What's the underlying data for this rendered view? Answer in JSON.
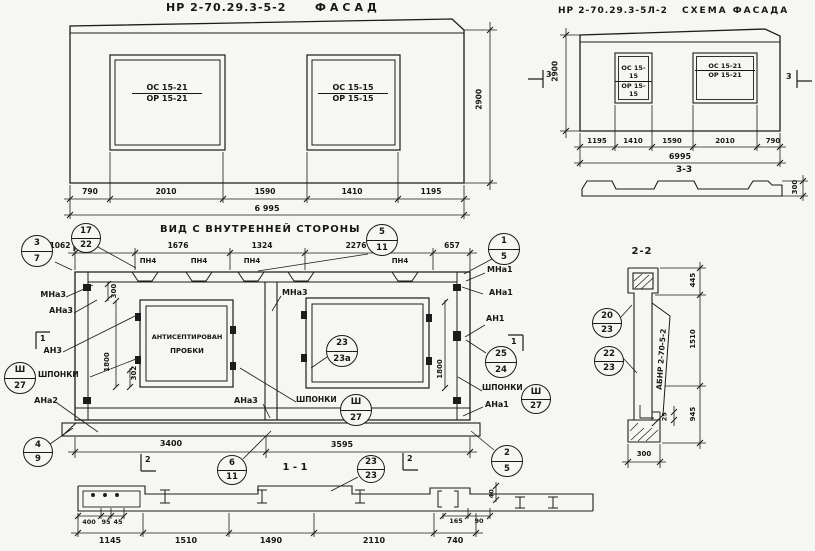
{
  "fl": {
    "code": "НР 2-70.29.3-5-2",
    "name": "ФАСАД",
    "wl": {
      "a": "ОС 15-21",
      "b": "ОР 15-21"
    },
    "wr": {
      "a": "ОС 15-15",
      "b": "ОР 15-15"
    },
    "h": "2900",
    "d1": "790",
    "d2": "2010",
    "d3": "1590",
    "d4": "1410",
    "d5": "1195",
    "total": "6 995"
  },
  "fr": {
    "code": "НР 2-70.29.3-5Л-2",
    "name": "СХЕМА ФАСАДА",
    "wl": {
      "a": "ОС 15-15",
      "b": "ОР 15-15"
    },
    "wr": {
      "a": "ОС 15-21",
      "b": "ОР 15-21"
    },
    "h": "2900",
    "mk": "3",
    "d1": "1195",
    "d2": "1410",
    "d3": "1590",
    "d4": "2010",
    "d5": "790",
    "total": "6995",
    "st": "3-3",
    "th": "300"
  },
  "iv": {
    "title": "ВИД С ВНУТРЕННЕЙ СТОРОНЫ",
    "d1": "1062",
    "d2": "1676",
    "d3": "1324",
    "d4": "2276",
    "d5": "657",
    "pn": "ПН4",
    "m1": "1",
    "m2": "2",
    "mna3": "МНа3",
    "ana3": "АНа3",
    "an3": "АН3",
    "ana2": "АНа2",
    "mna1": "МНа1",
    "ana1": "АНа1",
    "an1": "АН1",
    "sh": "ШПОНКИ",
    "note1": "АНТИСЕПТИРОВАН",
    "note2": "ПРОБКИ",
    "v300": "300",
    "v1800": "1800",
    "v302": "302",
    "b1": "3400",
    "b2": "3595"
  },
  "co": {
    "s3_7": [
      "3",
      "7"
    ],
    "s17_22": [
      "17",
      "22"
    ],
    "s5_11": [
      "5",
      "11"
    ],
    "s1_5": [
      "1",
      "5"
    ],
    "s4_9": [
      "4",
      "9"
    ],
    "s6_11": [
      "6",
      "11"
    ],
    "s2_5": [
      "2",
      "5"
    ],
    "sh27": [
      "Ш",
      "27"
    ],
    "s23_23a": [
      "23",
      "23а"
    ],
    "s25_24": [
      "25",
      "24"
    ],
    "s23_23": [
      "23",
      "23"
    ],
    "s20_23": [
      "20",
      "23"
    ],
    "s22_23": [
      "22",
      "23"
    ]
  },
  "s22": {
    "title": "2-2",
    "d445": "445",
    "d1510": "1510",
    "d945": "945",
    "d25": "25",
    "d300": "300",
    "stamp": "АБНР 2-70-5-2"
  },
  "s11": {
    "title": "1 - 1",
    "d400": "400",
    "d95": "95",
    "d45": "45",
    "d165": "165",
    "d90": "90",
    "d40": "40",
    "b1": "1145",
    "b2": "1510",
    "b3": "1490",
    "b4": "2110",
    "b5": "740"
  }
}
